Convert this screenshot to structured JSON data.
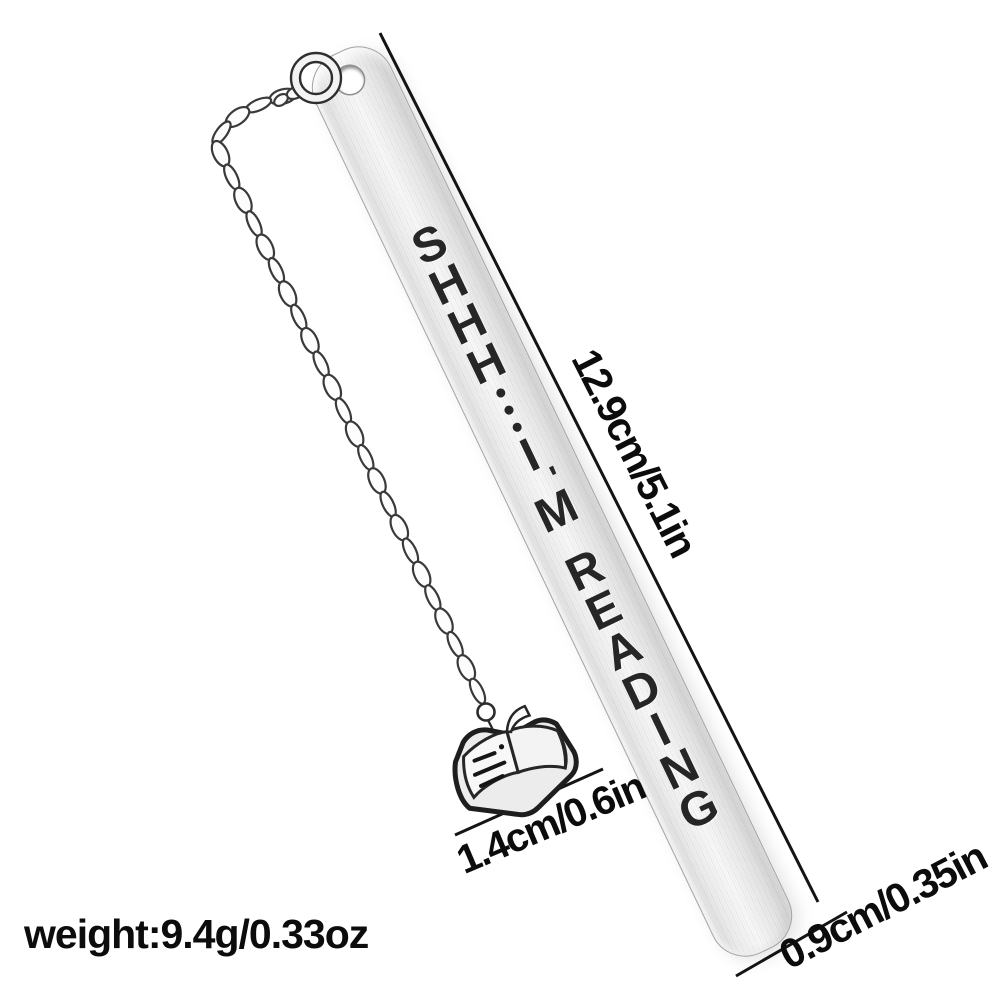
{
  "scene": {
    "background": "#ffffff",
    "style": "product-photo of stainless steel bookmark with chain and open-book charm"
  },
  "bookmark": {
    "engraving": "SHHH...I'M READING",
    "colors": {
      "metal_light": "#f8f8f8",
      "metal_shade": "#d5d5d5",
      "engraving_text": "#262626",
      "outline": "#2f2f2f"
    }
  },
  "labels": {
    "length": "12.9cm/5.1in",
    "charm_size": "1.4cm/0.6in",
    "bar_width": "0.9cm/0.35in",
    "weight": "weight:9.4g/0.33oz"
  },
  "icons": {
    "chain": "curb-chain",
    "ring": "jump-ring",
    "charm": "open-book"
  }
}
